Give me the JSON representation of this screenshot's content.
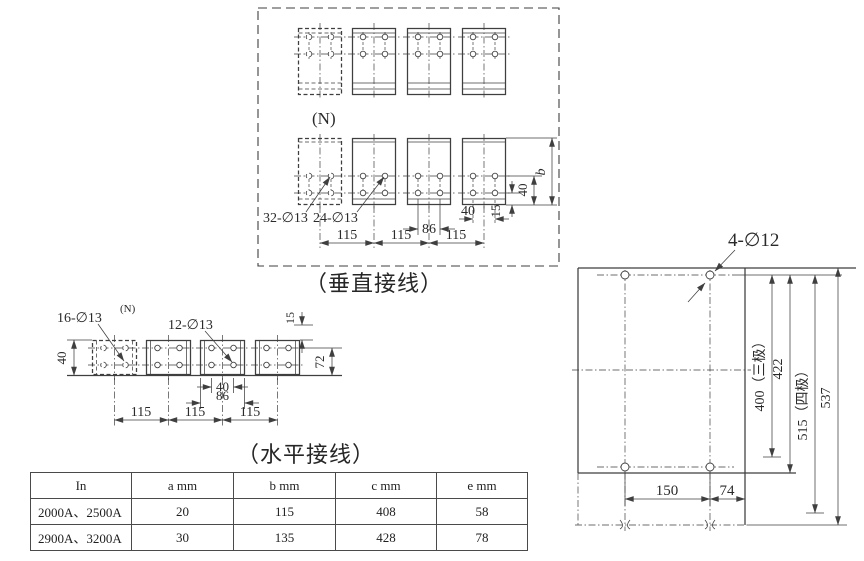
{
  "vertical_section": {
    "caption": "（垂直接线）",
    "n_label": "(N)",
    "hole_label_dashed": "32-∅13",
    "hole_label_solid": "24-∅13",
    "dim_86": "86",
    "dim_40_h": "40",
    "dim_pitch_1": "115",
    "dim_pitch_2": "115",
    "dim_pitch_3": "115",
    "dim_15": "15",
    "dim_40_v": "40",
    "dim_b": "b"
  },
  "horizontal_section": {
    "caption": "（水平接线）",
    "n_label": "(N)",
    "hole_label_dashed": "16-∅13",
    "hole_label_solid": "12-∅13",
    "dim_40_left": "40",
    "dim_15": "15",
    "dim_72": "72",
    "dim_40_holes": "40",
    "dim_86": "86",
    "dim_pitch_1": "115",
    "dim_pitch_2": "115",
    "dim_pitch_3": "115"
  },
  "mounting_section": {
    "hole_label": "4-∅12",
    "dim_150": "150",
    "dim_74": "74",
    "dim_400": "400（三极）",
    "dim_422": "422",
    "dim_515": "515（四极）",
    "dim_537": "537"
  },
  "table": {
    "headers": [
      "In",
      "a mm",
      "b mm",
      "c mm",
      "e mm"
    ],
    "rows": [
      [
        "2000A、2500A",
        "20",
        "115",
        "408",
        "58"
      ],
      [
        "2900A、3200A",
        "30",
        "135",
        "428",
        "78"
      ]
    ]
  }
}
